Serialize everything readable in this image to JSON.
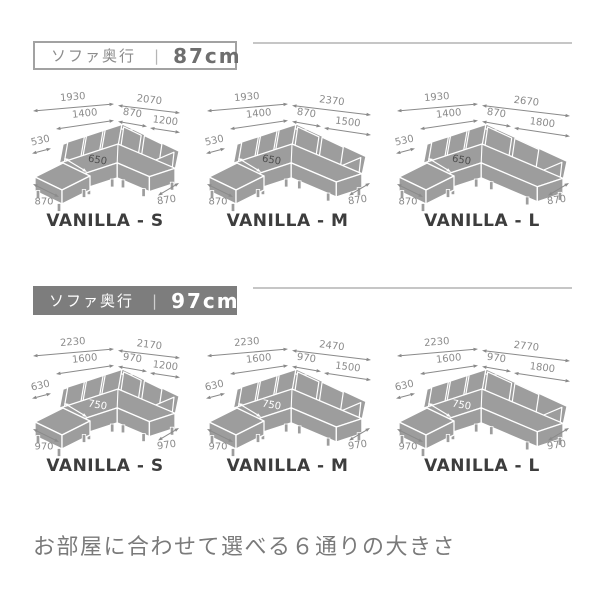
{
  "caption": "お部屋に合わせて選べる６通りの大きさ",
  "colors": {
    "sofa": "#9d9d9d",
    "sofa_outline": "#ffffff",
    "dimension": "#8a8a8a",
    "model_text": "#3d3d3d",
    "inner_dim_87": "#4f4f4f",
    "inner_dim_97": "#ffffff",
    "header_solid_bg": "#7d7d7d",
    "rule": "#c6c6c6",
    "caption_text": "#7a7a7a"
  },
  "sections": [
    {
      "header": {
        "label": "ソファ奥行",
        "separator": "|",
        "value": "87cm"
      },
      "diagrams": [
        {
          "label": "VANILLA - S",
          "size": "S",
          "dims": {
            "overall_left": "1930",
            "overall_right": "2070",
            "seat_left": "1400",
            "seat_corner": "870",
            "seat_right": "1200",
            "side": "530",
            "inner": "650",
            "bottom_left": "870",
            "bottom_right": "870"
          }
        },
        {
          "label": "VANILLA - M",
          "size": "M",
          "dims": {
            "overall_left": "1930",
            "overall_right": "2370",
            "seat_left": "1400",
            "seat_corner": "870",
            "seat_right": "1500",
            "side": "530",
            "inner": "650",
            "bottom_left": "870",
            "bottom_right": "870"
          }
        },
        {
          "label": "VANILLA - L",
          "size": "L",
          "dims": {
            "overall_left": "1930",
            "overall_right": "2670",
            "seat_left": "1400",
            "seat_corner": "870",
            "seat_right": "1800",
            "side": "530",
            "inner": "650",
            "bottom_left": "870",
            "bottom_right": "870"
          }
        }
      ]
    },
    {
      "header": {
        "label": "ソファ奥行",
        "separator": "|",
        "value": "97cm"
      },
      "diagrams": [
        {
          "label": "VANILLA - S",
          "size": "S",
          "dims": {
            "overall_left": "2230",
            "overall_right": "2170",
            "seat_left": "1600",
            "seat_corner": "970",
            "seat_right": "1200",
            "side": "630",
            "inner": "750",
            "bottom_left": "970",
            "bottom_right": "970"
          }
        },
        {
          "label": "VANILLA - M",
          "size": "M",
          "dims": {
            "overall_left": "2230",
            "overall_right": "2470",
            "seat_left": "1600",
            "seat_corner": "970",
            "seat_right": "1500",
            "side": "630",
            "inner": "750",
            "bottom_left": "970",
            "bottom_right": "970"
          }
        },
        {
          "label": "VANILLA - L",
          "size": "L",
          "dims": {
            "overall_left": "2230",
            "overall_right": "2770",
            "seat_left": "1600",
            "seat_corner": "970",
            "seat_right": "1800",
            "side": "630",
            "inner": "750",
            "bottom_left": "970",
            "bottom_right": "970"
          }
        }
      ]
    }
  ]
}
